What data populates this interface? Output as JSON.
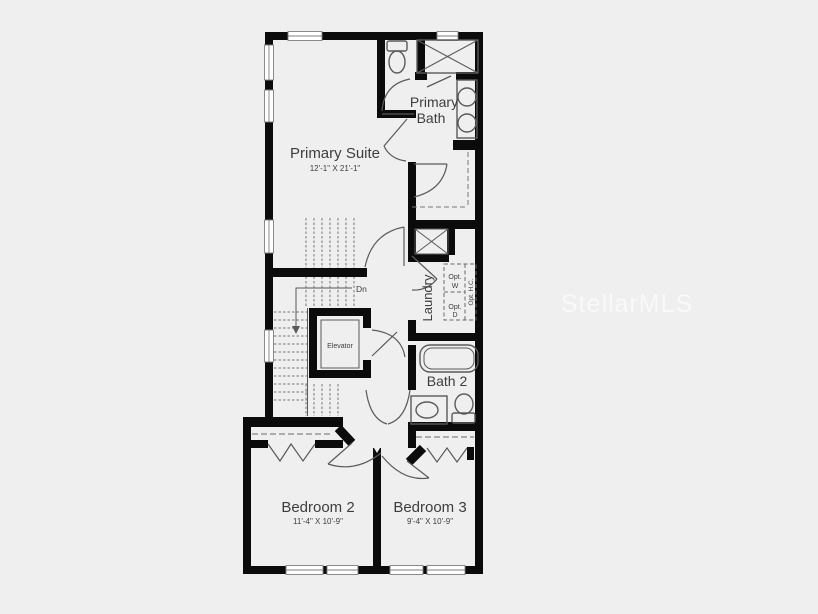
{
  "floor_plan": {
    "watermark": "StellarMLS",
    "rooms": {
      "primary_suite": {
        "label": "Primary Suite",
        "dimensions": "12'-1\" X 21'-1\""
      },
      "primary_bath": {
        "line1": "Primary",
        "line2": "Bath"
      },
      "laundry": {
        "label": "Laundry",
        "optional_washer": [
          "Opt.",
          "W"
        ],
        "optional_dryer": [
          "Opt.",
          "D"
        ],
        "optional_hc": "Opt. H.C."
      },
      "bath_2": {
        "label": "Bath 2"
      },
      "bedroom_2": {
        "label": "Bedroom 2",
        "dimensions": "11'-4\" X 10'-9\""
      },
      "bedroom_3": {
        "label": "Bedroom 3",
        "dimensions": "9'-4\" X 10'-9\""
      },
      "elevator": {
        "label": "Elevator"
      },
      "stairs": {
        "direction_label": "Dn"
      }
    },
    "colors": {
      "background": "#efefef",
      "walls": "#0b0b0b",
      "fixture_lines": "#5a5a5a",
      "text": "#3d3d3d",
      "watermark": "#ffffff"
    }
  }
}
